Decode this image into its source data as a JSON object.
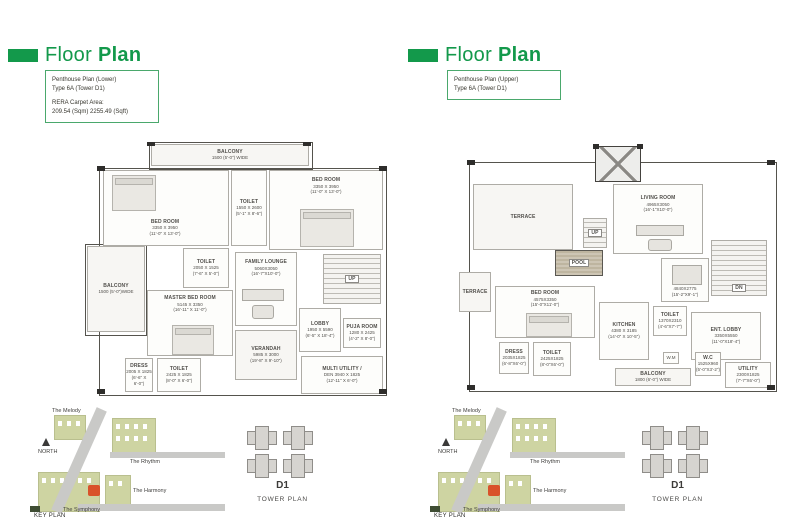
{
  "hdr": {
    "light": "Floor",
    "bold": "Plan"
  },
  "info_left": [
    "Penthouse Plan (Lower)",
    "Type 6A (Tower D1)",
    "RERA Carpet Area:",
    "209.54 (Sqm) 2255.49 (Sqft)"
  ],
  "info_right": [
    "Penthouse Plan (Upper)",
    "Type 6A (Tower D1)"
  ],
  "plan_lower": {
    "rooms": [
      {
        "name": "BALCONY",
        "size": "1500 (5'-0\") WIDE"
      },
      {
        "name": "BED ROOM",
        "size": "3350 X 3950",
        "feet": "(11'-0\" X 13'-0\")"
      },
      {
        "name": "TOILET",
        "size": "1550 X 2600",
        "feet": "(5'-1\" X 8'-6\")"
      },
      {
        "name": "BED ROOM",
        "size": "3350 X 3950",
        "feet": "(11'-0\" X 13'-0\")"
      },
      {
        "name": "TOILET",
        "size": "2050 X 1525",
        "feet": "(7'-6\" X 5'-0\")"
      },
      {
        "name": "BALCONY",
        "size": "1500 (5'-0\")WIDE"
      },
      {
        "name": "MASTER BED ROOM",
        "size": "5145 X 3350",
        "feet": "(16'-11\" X 11'-0\")"
      },
      {
        "name": "DRESS",
        "size": "2005 X 1825",
        "feet": "(6'-6\" X 6'-0\")"
      },
      {
        "name": "TOILET",
        "size": "2425 X 1825",
        "feet": "(8'-0\" X 6'-0\")"
      },
      {
        "name": "FAMILY LOUNGE",
        "size": "5060X3050",
        "feet": "(16'-7\"X10'-0\")"
      },
      {
        "name": "UP"
      },
      {
        "name": "LOBBY",
        "size": "1950 X 5590",
        "feet": "(6'-5\" X 18'-4\")"
      },
      {
        "name": "PUJA ROOM",
        "size": "1280 X 2425",
        "feet": "(4'-2\" X 8'-0\")"
      },
      {
        "name": "VERANDAH",
        "size": "5985 X 3000",
        "feet": "(19'-8\" X 9'-10\")"
      },
      {
        "name": "MULTI UTILITY /",
        "size": "DEN 3940 X 1825",
        "feet": "(12'-11\" X 6'-0\")"
      }
    ]
  },
  "plan_upper": {
    "rooms": [
      {
        "name": "TERRACE"
      },
      {
        "name": "LIVING ROOM",
        "size": "4965X3050",
        "feet": "(16'-1\"X10'-0\")"
      },
      {
        "name": "POOL"
      },
      {
        "name": "UP"
      },
      {
        "name": "DINING",
        "size": "4840X2775",
        "feet": "(15'-2\"X9'-1\")"
      },
      {
        "name": "TERRACE"
      },
      {
        "name": "BED ROOM",
        "size": "4575X3350",
        "feet": "(15'-0\"X11'-0\")"
      },
      {
        "name": "DRESS",
        "size": "2035X1825",
        "feet": "(6'-8\"X6'-0\")"
      },
      {
        "name": "TOILET",
        "size": "2425X1825",
        "feet": "(8'-0\"X6'-0\")"
      },
      {
        "name": "KITCHEN",
        "size": "4380 X 3185",
        "feet": "(14'-0\" X 10'-5\")"
      },
      {
        "name": "TOILET",
        "size": "1370X2310",
        "feet": "(4'-6\"X7'-7\")"
      },
      {
        "name": "ENT. LOBBY",
        "size": "3350X5550",
        "feet": "(11'-0\"X18'-4\")"
      },
      {
        "name": "DN"
      },
      {
        "name": "W.M"
      },
      {
        "name": "W.C",
        "size": "1525X960",
        "feet": "(5'-0\"X3'-2\")"
      },
      {
        "name": "BALCONY",
        "size": "1800 (6'-0\") WIDE"
      },
      {
        "name": "UTILITY",
        "size": "2300X1825",
        "feet": "(7'-7\"X6'-0\")"
      }
    ]
  },
  "key_plan": {
    "melody": "The Melody",
    "rhythm": "The Rhythm",
    "harmony": "The Harmony",
    "symphony": "The Symphony",
    "north": "NORTH",
    "caption": "KEY PLAN"
  },
  "tower_plan": {
    "name": "D1",
    "caption": "TOWER PLAN"
  },
  "colors": {
    "accent_green": "#13994b",
    "site_green": "#ced4a2",
    "highlight_orange": "#d9532b"
  }
}
